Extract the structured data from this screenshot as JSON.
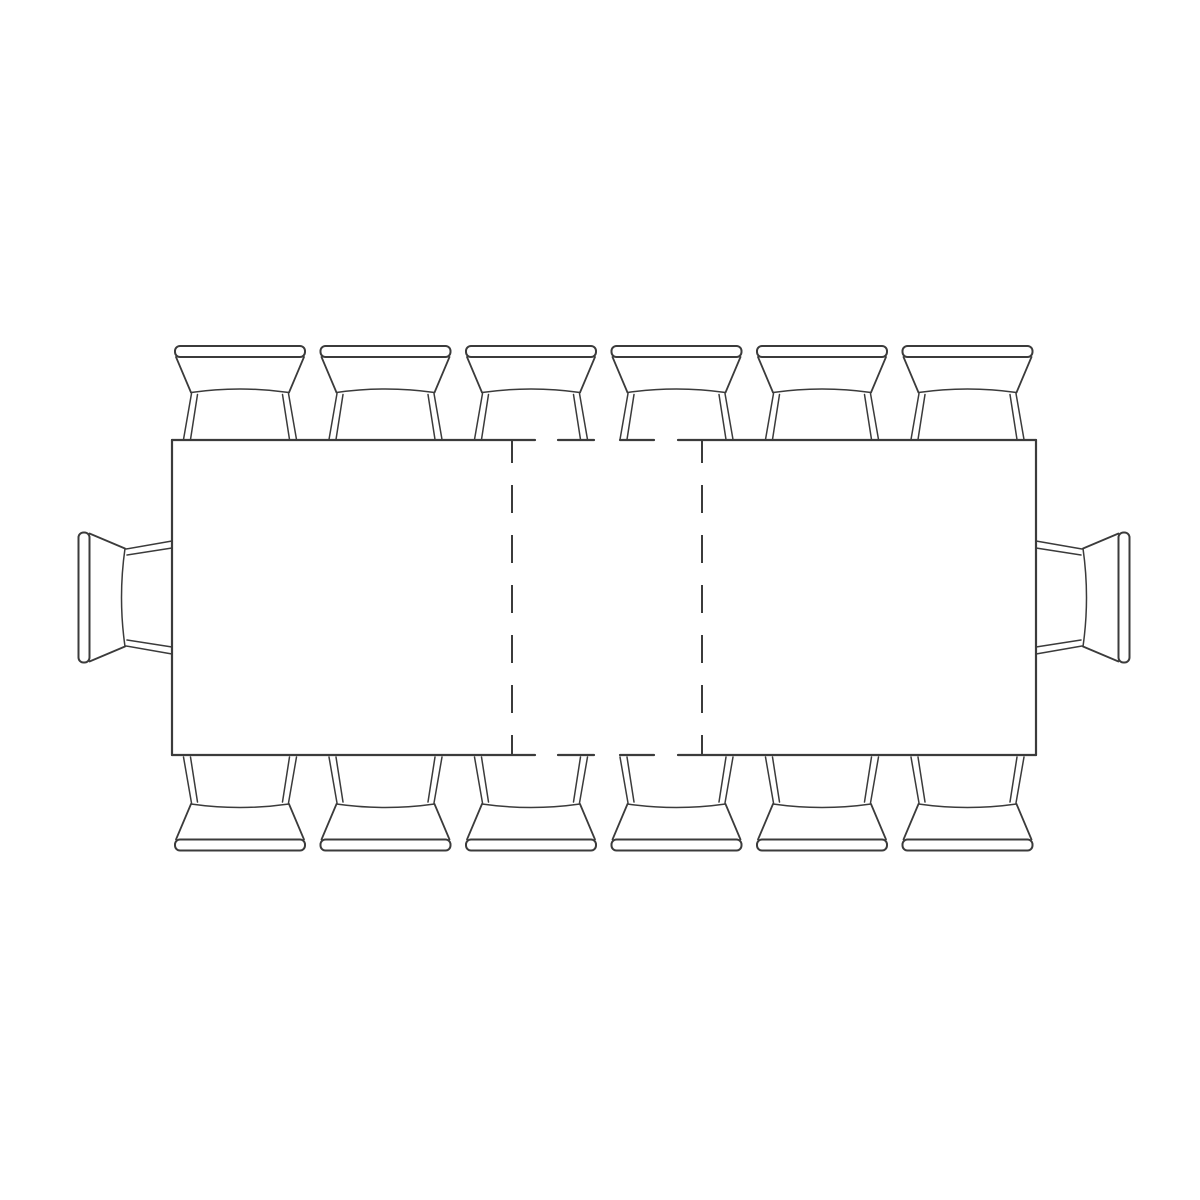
{
  "canvas": {
    "width": 1200,
    "height": 1200,
    "background": "#ffffff"
  },
  "style": {
    "line_color": "#3b3b3b",
    "edge_stroke_width": 2.2,
    "leaf_stroke_width": 2
  },
  "table": {
    "kind": "extendable-dining-table-top-view",
    "rect": {
      "x": 172,
      "y": 440,
      "width": 864,
      "height": 315
    },
    "solid_edge_segments_x": [
      [
        172,
        535
      ],
      [
        558,
        594
      ],
      [
        620,
        654
      ],
      [
        678,
        1036
      ]
    ],
    "extension_leaf": {
      "line_x": [
        512,
        702
      ],
      "dash": [
        28,
        22
      ],
      "dash_offset": 6
    }
  },
  "chairs": {
    "count": 14,
    "top_row": {
      "centers_x": [
        240,
        385.5,
        531,
        676.5,
        822,
        967.5
      ],
      "rail_y": 346
    },
    "bottom_row": {
      "centers_x": [
        240,
        385.5,
        531,
        676.5,
        822,
        967.5
      ],
      "rail_y": 850.5
    },
    "left_end": {
      "rail_x": 78.5,
      "center_y": 597.5
    },
    "right_end": {
      "rail_x": 1129.5,
      "center_y": 597.5
    }
  }
}
